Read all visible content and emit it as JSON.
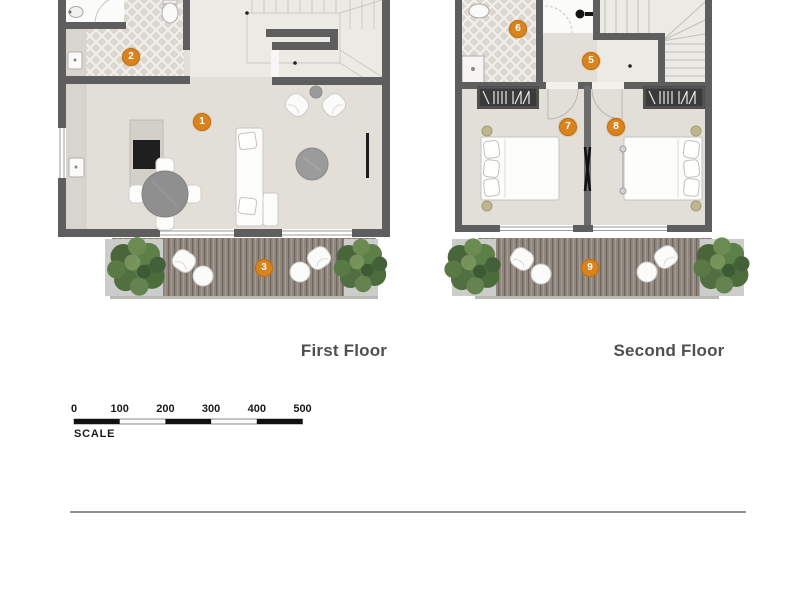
{
  "document": {
    "type": "architectural floor plan sheet",
    "background": "#ffffff"
  },
  "floor_plans": [
    {
      "label": "First Floor",
      "markers": [
        {
          "number": "1"
        },
        {
          "number": "2"
        },
        {
          "number": "3"
        }
      ]
    },
    {
      "label": "Second Floor",
      "markers": [
        {
          "number": "5"
        },
        {
          "number": "6"
        },
        {
          "number": "7"
        },
        {
          "number": "8"
        },
        {
          "number": "9"
        }
      ]
    }
  ],
  "scale_bar": {
    "label": "SCALE",
    "tick_labels": [
      "0",
      "100",
      "200",
      "300",
      "400",
      "500"
    ]
  },
  "colors": {
    "marker_fill": "#d9831f",
    "marker_text": "#ffffff",
    "wall": "#5e5e5e",
    "floor": "#e2dfd8",
    "tile_floor": "#dbd7d0",
    "deck": "#90877e",
    "planter": "#ccccca",
    "plant": "#55753f",
    "floor_label_text": "#4f4f4f",
    "scale_text": "#1a1a1a",
    "divider_line": "#909090"
  }
}
